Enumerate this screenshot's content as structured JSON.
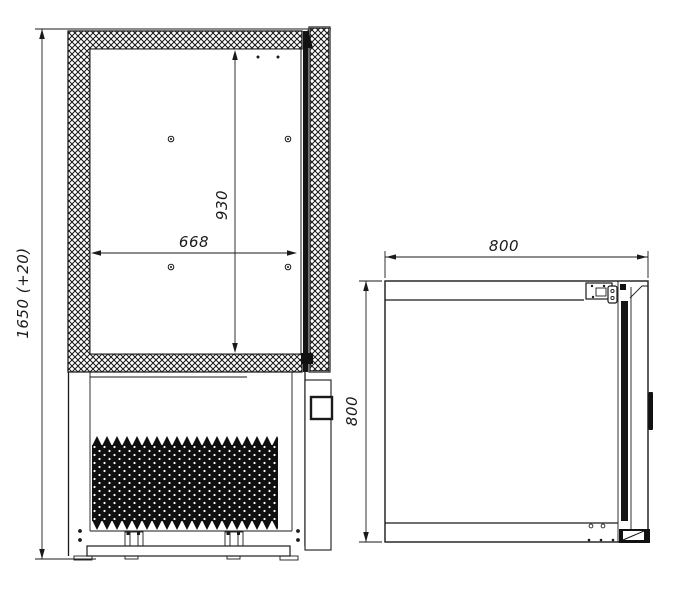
{
  "drawing": {
    "colors": {
      "ink": "#1a1a1a",
      "paper": "#ffffff"
    },
    "views": {
      "left": "front-section-view",
      "right": "plan-view"
    }
  },
  "dimensions": {
    "front_view": [
      {
        "id": "overall-height",
        "label": "1650 (+20)",
        "orientation": "vertical"
      },
      {
        "id": "interior-height",
        "label": "930",
        "orientation": "vertical"
      },
      {
        "id": "interior-width",
        "label": "668",
        "orientation": "horizontal"
      }
    ],
    "plan_view": [
      {
        "id": "overall-width",
        "label": "800",
        "orientation": "horizontal"
      },
      {
        "id": "overall-depth",
        "label": "800",
        "orientation": "vertical"
      }
    ]
  }
}
